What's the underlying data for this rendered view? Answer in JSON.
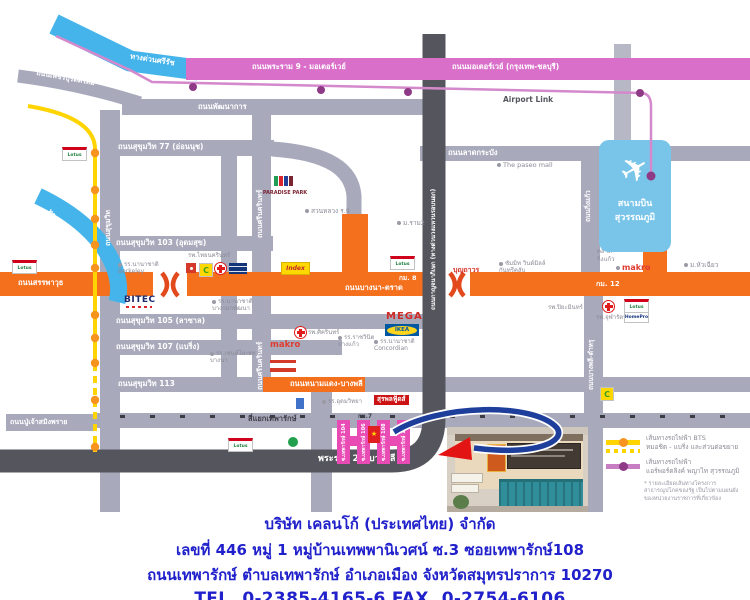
{
  "roads": {
    "phetchaburi": "ถนนเพชรบุรีตัดใหม่",
    "srirat": "ทางด่วนศรีรัช",
    "rama9_motorway": "ถนนพระราม 9 - มอเตอร์เวย์",
    "motorway": "ถนนมอเตอร์เวย์ (กรุงเทพ-ชลบุรี)",
    "airport_link": "Airport Link",
    "phatthanakan": "ถนนพัฒนาการ",
    "lat_krabang": "ถนนลาดกระบัง",
    "sukhumvit": "ถนนสุขุมวิท",
    "sukhumvit77": "ถนนสุขุมวิท 77 (อ่อนนุช)",
    "sukhumvit103": "ถนนสุขุมวิท 103 (อุดมสุข)",
    "sukhumvit105": "ถนนสุขุมวิท 105 (ลาซาล)",
    "sukhumvit107": "ถนนสุขุมวิท 107 (แบริ่ง)",
    "sukhumvit113": "ถนนสุขุมวิท 113",
    "srinagarindra": "ถนนศรีนครินทร์",
    "sanphawut": "ถนนสรรพาวุธ",
    "bangna_trat": "ถนนบางนา-ตราด",
    "din_daeng": "ทางด่วนดินแดง-บางนา",
    "kanchanaphisek": "ถนนกาญจนาภิเษก (ทางด่วนวงแหวนรอบนอก)",
    "king_kaeo": "ถนนกิ่งแก้ว",
    "bangphli_tamru": "ถนนบางพลี-ตำหรุ",
    "nam_daeng": "ถนนหนามแดง-บางพลี",
    "thepharak_junction": "สี่แยกเทพารักษ์",
    "pu_chao": "ถนนปู่เจ้าสมิงพราย",
    "rama2": "พระราม 2 - บางพลี"
  },
  "km": {
    "km7": "กม.7",
    "km8": "กม. 8",
    "km12": "กม. 12"
  },
  "airport": {
    "line1": "สนามบิน",
    "line2": "สุวรรณภูมิ"
  },
  "icons": {
    "plane": "✈",
    "star": "★"
  },
  "landmarks": {
    "paradise_park": "PARADISE PARK",
    "suan_luang": "สวนหลวง ร.9",
    "the_paseo": "The paseo mall",
    "ram2": "ม.ราม2",
    "thainakarin": "รพ.ไทยนครินทร์",
    "berkeley_1": "รร.นานาชาติ",
    "berkeley_2": "Berkeley",
    "bitec": "BITEC",
    "patana_1": "รร.นานาชาติ",
    "patana_2": "บางกอกพัฒนา",
    "st_joseph_1": "รร.เซนต์โยเซฟ",
    "st_joseph_2": "บางนา",
    "sikarin": "รพ.ศิครินทร์",
    "ratchawinit_1": "รร.ราชวินิต",
    "ratchawinit_2": "บางแก้ว",
    "makro": "makro",
    "mega": "MEGA",
    "ikea": "IKEA",
    "concordian_1": "รร.นานาชาติ",
    "concordian_2": "Concordian",
    "boonthavorn": "บุญถาวร",
    "summit_1": "ซัมมิท วินด์มิลล์",
    "summit_2": "กันทรีคลับ",
    "piyamin": "รพ.ปิยะมินทร์",
    "chularat": "รพ.จุฬารัตน์",
    "talat_king_kaeo_1": "ตลาด",
    "talat_king_kaeo_2": "กิ่งแก้ว",
    "huachiew": "ม.หัวเฉียว",
    "surapon": "สุรพลฟู้ดส์",
    "udomwit": "รร.อุดมวิทยา",
    "index": "Index",
    "lotus": "Lotus",
    "homepro": "HomePro",
    "bigc": "C"
  },
  "sois": [
    "ซ.เทพารักษ์ 104",
    "ซ.เทพารักษ์ 106",
    "ซ.เทพารักษ์ 108",
    "ซ.เทพารักษ์ 110"
  ],
  "legend": {
    "bts_line1": "เส้นทางรถไฟฟ้า BTS",
    "bts_line2": "หมอชิต - แบริ่ง และส่วนต่อขยาย",
    "arl_line1": "เส้นทางรถไฟฟ้า",
    "arl_line2": "แอร์พอร์ตลิงค์ พญาไท สุวรรณภูมิ",
    "note": "* รายละเอียดเส้นทางโครงการสาธารณูปโภคของรัฐ เป็นไปตามแผนผังของหน่วยงานราชการที่เกี่ยวข้อง"
  },
  "address": {
    "company": "บริษัท เคลนโก้ (ประเทศไทย) จำกัด",
    "line1": "เลขที่ 446 หมู่ 1 หมู่บ้านเทพพานิเวศน์ ซ.3 ซอยเทพารักษ์108",
    "line2": "ถนนเทพารักษ์ ตำบลเทพารักษ์ อำเภอเมือง จังหวัดสมุทรปราการ 10270",
    "phone": "TEL. 0-2385-4165-6   FAX. 0-2754-6106"
  },
  "colors": {
    "orange": "#F4701D",
    "pink": "#D96FC9",
    "blue": "#45B4EA",
    "yellow": "#FFD400",
    "soi_magenta": "#E94BB5",
    "address_blue": "#2121CC"
  }
}
